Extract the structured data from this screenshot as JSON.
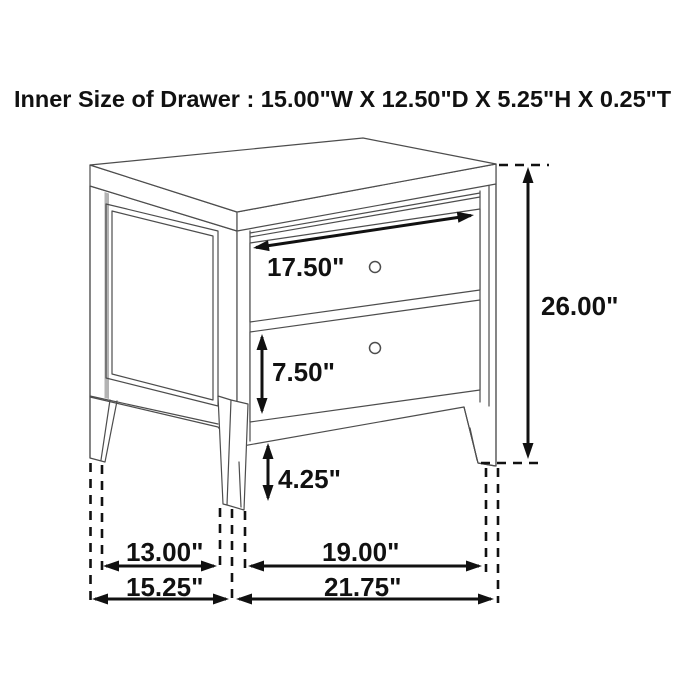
{
  "title": "Inner Size of Drawer : 15.00\"W X 12.50\"D X 5.25\"H X 0.25\"T",
  "diagram": {
    "kind": "furniture dimension line drawing",
    "item": "two-drawer nightstand with tapered legs",
    "drawer_count": 2
  },
  "labels": {
    "drawer_width": "17.50\"",
    "drawer2_height": "7.50\"",
    "bottom_clearance": "4.25\"",
    "overall_height": "26.00\"",
    "side_inner_span": "13.00\"",
    "overall_depth": "15.25\"",
    "front_inner_span": "19.00\"",
    "overall_width": "21.75\""
  },
  "colors": {
    "background": "#ffffff",
    "furniture_line": "#4d4d4d",
    "dimension_line": "#111111",
    "text": "#111111",
    "panel_shadow": "#b3b3b3"
  }
}
